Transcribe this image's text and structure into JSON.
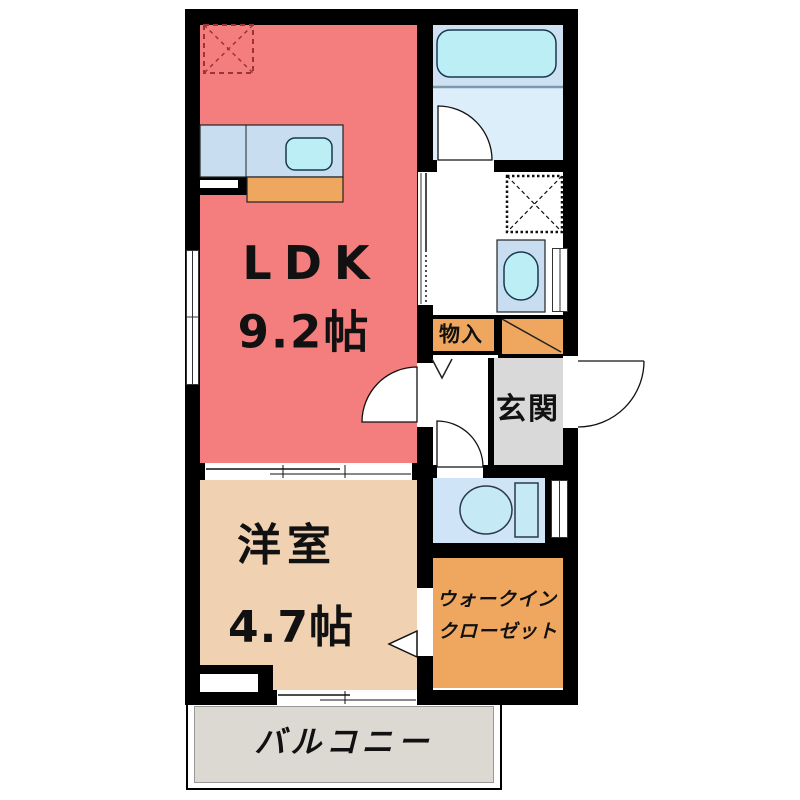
{
  "plan": {
    "rooms": {
      "ldk": {
        "name": "LDK",
        "size": "9.2帖"
      },
      "western_room": {
        "name": "洋室",
        "size": "4.7帖"
      },
      "walk_in_closet": {
        "line1": "ウォークイン",
        "line2": "クローゼット"
      },
      "entrance": {
        "name": "玄関"
      },
      "storage": {
        "name": "物入"
      },
      "balcony": {
        "name": "バルコニー"
      }
    },
    "colors": {
      "ldk": "#f47e7e",
      "western_room": "#f0d2b2",
      "closet_orange": "#efa75f",
      "storage_orange": "#efa75f",
      "entrance_gray": "#d9d9d9",
      "balcony_gray": "#dcd8d2",
      "bath_tub_zone": "#cde1f3",
      "bath_floor_zone": "#dceef9",
      "washroom_white": "#ffffff",
      "toilet_room": "#cfe4f6",
      "counter_blue": "#c9ddf1",
      "fixture_cyan": "#bceef6",
      "wall_black": "#000000",
      "fridge_dash_red": "#9b3535"
    }
  }
}
